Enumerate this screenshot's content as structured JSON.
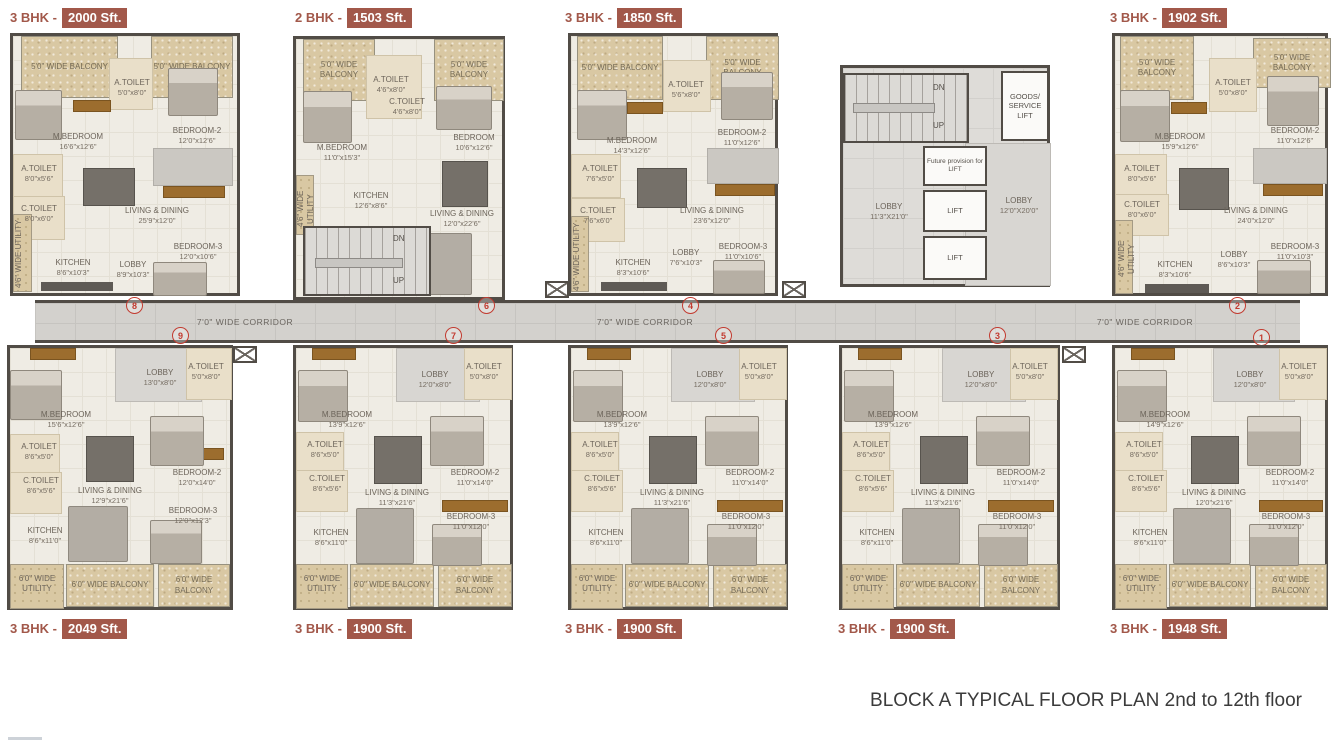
{
  "title": "BLOCK A TYPICAL FLOOR PLAN 2nd to 12th floor",
  "badge_sep": "-",
  "corridor_label": "7'0\" WIDE CORRIDOR",
  "colors": {
    "badge": "#a2584a",
    "wall": "#514c46",
    "floor": "#efece4",
    "balcony": "#d9c8a3",
    "corridor": "#d3d1cd",
    "wood_accent": "#9c6d2e",
    "unit_number": "#c23b30"
  },
  "core": {
    "stair_dn": "DN",
    "stair_up": "UP",
    "goods_lift": "GOODS/ SERVICE LIFT",
    "future_lift": "Future provision for LIFT",
    "lift1": "LIFT",
    "lift2": "LIFT",
    "lobby_left": {
      "name": "LOBBY",
      "dims": "11'3\"X21'0\""
    },
    "lobby_right": {
      "name": "LOBBY",
      "dims": "12'0\"X20'0\""
    }
  },
  "units": [
    {
      "bhk": "3 BHK",
      "area": "2000 Sft.",
      "number": "8",
      "rooms": {
        "balcony1": "5'0\" WIDE BALCONY",
        "balcony2": "5'0\" WIDE BALCONY",
        "mbedroom": {
          "name": "M.BEDROOM",
          "dims": "16'6\"x12'6\""
        },
        "atoilet1": {
          "name": "A.TOILET",
          "dims": "5'0\"x8'0\""
        },
        "bedroom2": {
          "name": "BEDROOM-2",
          "dims": "12'0\"x12'6\""
        },
        "atoilet2": {
          "name": "A.TOILET",
          "dims": "8'0\"x5'6\""
        },
        "ctoilet": {
          "name": "C.TOILET",
          "dims": "8'0\"x6'0\""
        },
        "living": {
          "name": "LIVING & DINING",
          "dims": "25'9\"x12'0\""
        },
        "utility": "4'6\" WIDE UTILITY",
        "kitchen": {
          "name": "KITCHEN",
          "dims": "8'6\"x10'3\""
        },
        "lobby": {
          "name": "LOBBY",
          "dims": "8'9\"x10'3\""
        },
        "bedroom3": {
          "name": "BEDROOM-3",
          "dims": "12'0\"x10'6\""
        }
      }
    },
    {
      "bhk": "2 BHK",
      "area": "1503 Sft.",
      "number": "6",
      "rooms": {
        "balcony1": "5'0\" WIDE BALCONY",
        "balcony2": "5'0\" WIDE BALCONY",
        "atoilet": {
          "name": "A.TOILET",
          "dims": "4'6\"x8'0\""
        },
        "ctoilet": {
          "name": "C.TOILET",
          "dims": "4'6\"x8'0\""
        },
        "mbedroom": {
          "name": "M.BEDROOM",
          "dims": "11'0\"x15'3\""
        },
        "bedroom": {
          "name": "BEDROOM",
          "dims": "10'6\"x12'6\""
        },
        "utility": "4'6\" WIDE UTILITY",
        "kitchen": {
          "name": "KITCHEN",
          "dims": "12'6\"x8'6\""
        },
        "living": {
          "name": "LIVING & DINING",
          "dims": "12'0\"x22'6\""
        },
        "stair_dn": "DN",
        "stair_up": "UP"
      }
    },
    {
      "bhk": "3 BHK",
      "area": "1850 Sft.",
      "number": "4",
      "rooms": {
        "balcony1": "5'0\" WIDE BALCONY",
        "balcony2": "5'0\" WIDE BALCONY",
        "mbedroom": {
          "name": "M.BEDROOM",
          "dims": "14'3\"x12'6\""
        },
        "atoilet1": {
          "name": "A.TOILET",
          "dims": "5'6\"x8'0\""
        },
        "bedroom2": {
          "name": "BEDROOM-2",
          "dims": "11'0\"x12'6\""
        },
        "atoilet2": {
          "name": "A.TOILET",
          "dims": "7'6\"x5'0\""
        },
        "ctoilet": {
          "name": "C.TOILET",
          "dims": "7'6\"x6'0\""
        },
        "living": {
          "name": "LIVING & DINING",
          "dims": "23'6\"x12'0\""
        },
        "utility": "4'6\" WIDE UTILITY",
        "kitchen": {
          "name": "KITCHEN",
          "dims": "8'3\"x10'6\""
        },
        "lobby": {
          "name": "LOBBY",
          "dims": "7'6\"x10'3\""
        },
        "bedroom3": {
          "name": "BEDROOM-3",
          "dims": "11'0\"x10'6\""
        }
      }
    },
    {
      "bhk": "3 BHK",
      "area": "1902 Sft.",
      "number": "2",
      "rooms": {
        "balcony1": "5'0\" WIDE BALCONY",
        "balcony2": "5'0\" WIDE BALCONY",
        "mbedroom": {
          "name": "M.BEDROOM",
          "dims": "15'9\"x12'6\""
        },
        "atoilet1": {
          "name": "A.TOILET",
          "dims": "5'0\"x8'0\""
        },
        "bedroom2": {
          "name": "BEDROOM-2",
          "dims": "11'0\"x12'6\""
        },
        "atoilet2": {
          "name": "A.TOILET",
          "dims": "8'0\"x5'6\""
        },
        "ctoilet": {
          "name": "C.TOILET",
          "dims": "8'0\"x6'0\""
        },
        "living": {
          "name": "LIVING & DINING",
          "dims": "24'0\"x12'0\""
        },
        "utility": "4'6\" WIDE UTILITY",
        "kitchen": {
          "name": "KITCHEN",
          "dims": "8'3\"x10'6\""
        },
        "lobby": {
          "name": "LOBBY",
          "dims": "8'6\"x10'3\""
        },
        "bedroom3": {
          "name": "BEDROOM-3",
          "dims": "11'0\"x10'3\""
        }
      }
    },
    {
      "bhk": "3 BHK",
      "area": "2049 Sft.",
      "number": "9",
      "rooms": {
        "lobby": {
          "name": "LOBBY",
          "dims": "13'0\"x8'0\""
        },
        "atoilet1": {
          "name": "A.TOILET",
          "dims": "5'0\"x8'0\""
        },
        "mbedroom": {
          "name": "M.BEDROOM",
          "dims": "15'6\"x12'6\""
        },
        "atoilet2": {
          "name": "A.TOILET",
          "dims": "8'6\"x5'0\""
        },
        "ctoilet": {
          "name": "C.TOILET",
          "dims": "8'6\"x5'6\""
        },
        "living": {
          "name": "LIVING & DINING",
          "dims": "12'9\"x21'6\""
        },
        "bedroom2": {
          "name": "BEDROOM-2",
          "dims": "12'0\"x14'0\""
        },
        "bedroom3": {
          "name": "BEDROOM-3",
          "dims": "12'0\"x12'3\""
        },
        "kitchen": {
          "name": "KITCHEN",
          "dims": "8'6\"x11'0\""
        },
        "utility": "6'0\" WIDE UTILITY",
        "balcony1": "6'0\" WIDE BALCONY",
        "balcony2": "6'0\" WIDE BALCONY"
      }
    },
    {
      "bhk": "3 BHK",
      "area": "1900 Sft.",
      "number": "7",
      "rooms": {
        "lobby": {
          "name": "LOBBY",
          "dims": "12'0\"x8'0\""
        },
        "atoilet1": {
          "name": "A.TOILET",
          "dims": "5'0\"x8'0\""
        },
        "mbedroom": {
          "name": "M.BEDROOM",
          "dims": "13'9\"x12'6\""
        },
        "atoilet2": {
          "name": "A.TOILET",
          "dims": "8'6\"x5'0\""
        },
        "ctoilet": {
          "name": "C.TOILET",
          "dims": "8'6\"x5'6\""
        },
        "living": {
          "name": "LIVING & DINING",
          "dims": "11'3\"x21'6\""
        },
        "bedroom2": {
          "name": "BEDROOM-2",
          "dims": "11'0\"x14'0\""
        },
        "bedroom3": {
          "name": "BEDROOM-3",
          "dims": "11'0\"x12'0\""
        },
        "kitchen": {
          "name": "KITCHEN",
          "dims": "8'6\"x11'0\""
        },
        "utility": "6'0\" WIDE UTILITY",
        "balcony1": "6'0\" WIDE BALCONY",
        "balcony2": "6'0\" WIDE BALCONY"
      }
    },
    {
      "bhk": "3 BHK",
      "area": "1900 Sft.",
      "number": "5",
      "rooms": {
        "lobby": {
          "name": "LOBBY",
          "dims": "12'0\"x8'0\""
        },
        "atoilet1": {
          "name": "A.TOILET",
          "dims": "5'0\"x8'0\""
        },
        "mbedroom": {
          "name": "M.BEDROOM",
          "dims": "13'9\"x12'6\""
        },
        "atoilet2": {
          "name": "A.TOILET",
          "dims": "8'6\"x5'0\""
        },
        "ctoilet": {
          "name": "C.TOILET",
          "dims": "8'6\"x5'6\""
        },
        "living": {
          "name": "LIVING & DINING",
          "dims": "11'3\"x21'6\""
        },
        "bedroom2": {
          "name": "BEDROOM-2",
          "dims": "11'0\"x14'0\""
        },
        "bedroom3": {
          "name": "BEDROOM-3",
          "dims": "11'0\"x12'0\""
        },
        "kitchen": {
          "name": "KITCHEN",
          "dims": "8'6\"x11'0\""
        },
        "utility": "6'0\" WIDE UTILITY",
        "balcony1": "6'0\" WIDE BALCONY",
        "balcony2": "6'0\" WIDE BALCONY"
      }
    },
    {
      "bhk": "3 BHK",
      "area": "1900 Sft.",
      "number": "3",
      "rooms": {
        "lobby": {
          "name": "LOBBY",
          "dims": "12'0\"x8'0\""
        },
        "atoilet1": {
          "name": "A.TOILET",
          "dims": "5'0\"x8'0\""
        },
        "mbedroom": {
          "name": "M.BEDROOM",
          "dims": "13'9\"x12'6\""
        },
        "atoilet2": {
          "name": "A.TOILET",
          "dims": "8'6\"x5'0\""
        },
        "ctoilet": {
          "name": "C.TOILET",
          "dims": "8'6\"x5'6\""
        },
        "living": {
          "name": "LIVING & DINING",
          "dims": "11'3\"x21'6\""
        },
        "bedroom2": {
          "name": "BEDROOM-2",
          "dims": "11'0\"x14'0\""
        },
        "bedroom3": {
          "name": "BEDROOM-3",
          "dims": "11'0\"x12'0\""
        },
        "kitchen": {
          "name": "KITCHEN",
          "dims": "8'6\"x11'0\""
        },
        "utility": "6'0\" WIDE UTILITY",
        "balcony1": "6'0\" WIDE BALCONY",
        "balcony2": "6'0\" WIDE BALCONY"
      }
    },
    {
      "bhk": "3 BHK",
      "area": "1948 Sft.",
      "number": "1",
      "rooms": {
        "lobby": {
          "name": "LOBBY",
          "dims": "12'0\"x8'0\""
        },
        "atoilet1": {
          "name": "A.TOILET",
          "dims": "5'0\"x8'0\""
        },
        "mbedroom": {
          "name": "M.BEDROOM",
          "dims": "14'9\"x12'6\""
        },
        "atoilet2": {
          "name": "A.TOILET",
          "dims": "8'6\"x5'0\""
        },
        "ctoilet": {
          "name": "C.TOILET",
          "dims": "8'6\"x5'6\""
        },
        "living": {
          "name": "LIVING & DINING",
          "dims": "12'0\"x21'6\""
        },
        "bedroom2": {
          "name": "BEDROOM-2",
          "dims": "11'0\"x14'0\""
        },
        "bedroom3": {
          "name": "BEDROOM-3",
          "dims": "11'0\"x12'0\""
        },
        "kitchen": {
          "name": "KITCHEN",
          "dims": "8'6\"x11'0\""
        },
        "utility": "6'0\" WIDE UTILITY",
        "balcony1": "6'0\" WIDE BALCONY",
        "balcony2": "6'0\" WIDE BALCONY"
      }
    }
  ]
}
